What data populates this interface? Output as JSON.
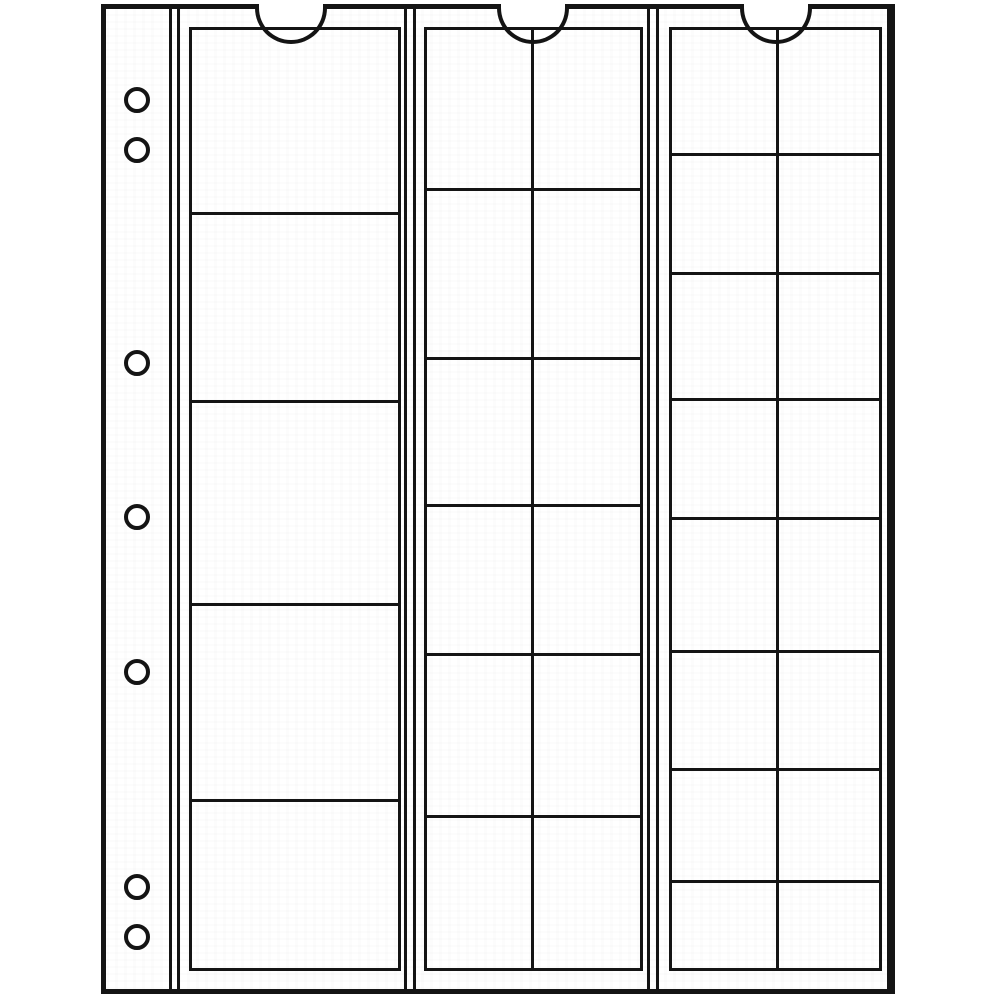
{
  "sheet": {
    "description": "transparent coin-album pocket page, line drawing, no text",
    "total_pockets": 33
  },
  "colors": {
    "line": "#141414",
    "background": "#ffffff"
  },
  "canvas": {
    "width": 1000,
    "height": 1000
  },
  "page": {
    "x": 101,
    "y": 4,
    "width": 794,
    "height": 990,
    "border_px": 5,
    "inner_top": 9,
    "inner_bottom": 989
  },
  "line_px": 3,
  "binder_margin": {
    "line_x": 169,
    "hole_cx": 137,
    "hole_radius": 13,
    "hole_stroke_px": 4,
    "hole_centers_y": [
      100,
      150,
      363,
      517,
      672,
      887,
      937
    ]
  },
  "notch": {
    "radius": 36,
    "stroke_px": 4
  },
  "strips": [
    {
      "id": "strip-large-pockets",
      "left_line_x": 177,
      "right_line_x": 404,
      "notch_cx": 291,
      "pocket": {
        "left": 189,
        "top": 27,
        "width": 212,
        "height": 944
      },
      "row_lines_y": [
        212,
        400,
        603,
        799
      ],
      "divider_lines_x": [],
      "pocket_count": 5
    },
    {
      "id": "strip-medium-pockets",
      "left_line_x": 413,
      "right_line_x": 647,
      "notch_cx": 533,
      "pocket": {
        "left": 424,
        "top": 27,
        "width": 219,
        "height": 944
      },
      "row_lines_y": [
        188,
        357,
        504,
        653,
        815
      ],
      "divider_lines_x": [
        531
      ],
      "pocket_count": 12
    },
    {
      "id": "strip-small-pockets",
      "left_line_x": 656,
      "right_line_x": 887,
      "notch_cx": 776,
      "pocket": {
        "left": 669,
        "top": 27,
        "width": 213,
        "height": 944
      },
      "row_lines_y": [
        153,
        272,
        398,
        517,
        650,
        768,
        880
      ],
      "divider_lines_x": [
        776
      ],
      "pocket_count": 16
    }
  ]
}
